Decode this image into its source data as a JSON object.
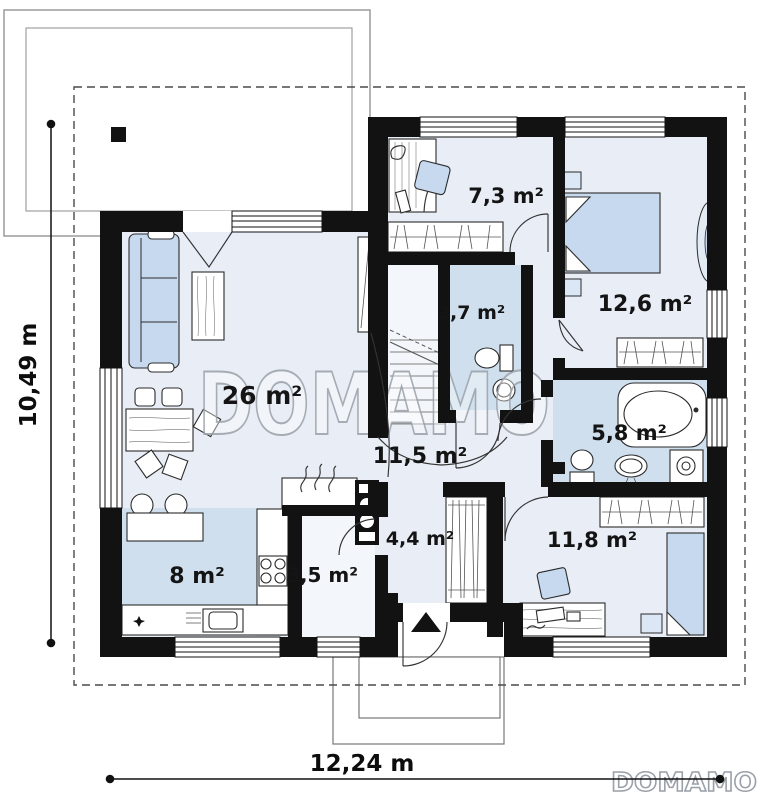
{
  "floorplan": {
    "watermark_center": "DOMAMO",
    "brand_logo": "DOMAMO",
    "dimensions": {
      "vertical_label": "10,49 m",
      "horizontal_label": "12,24 m"
    },
    "rooms": [
      {
        "name": "living-room",
        "area_label": "26 m²"
      },
      {
        "name": "office",
        "area_label": "7,3 m²"
      },
      {
        "name": "bedroom-1",
        "area_label": "12,6 m²"
      },
      {
        "name": "toilet",
        "area_label": "2,7 m²"
      },
      {
        "name": "hallway",
        "area_label": "11,5 m²"
      },
      {
        "name": "bathroom",
        "area_label": "5,8 m²"
      },
      {
        "name": "entrance-hall",
        "area_label": "4,4 m²"
      },
      {
        "name": "pantry",
        "area_label": "3,5 m²"
      },
      {
        "name": "kitchen",
        "area_label": "8 m²"
      },
      {
        "name": "bedroom-2",
        "area_label": "11,8 m²"
      }
    ],
    "colors": {
      "wall": "#121212",
      "floor": "#e8edf6",
      "wet_floor": "#cfdfee",
      "furniture_blue": "#c7d9ef",
      "watermark": "#9aa0a8"
    }
  }
}
